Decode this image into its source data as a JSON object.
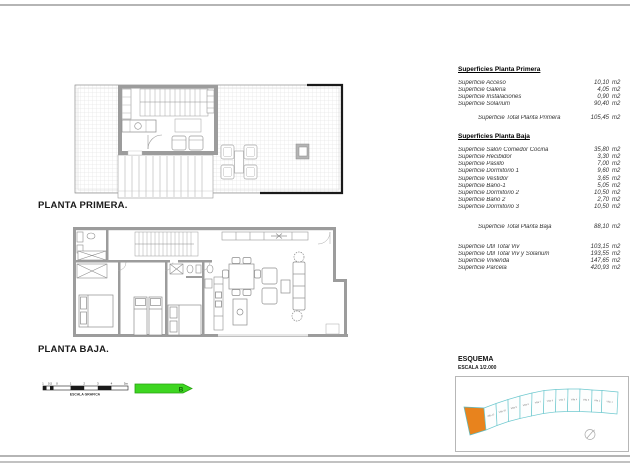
{
  "plans": {
    "primera_label": "PLANTA PRIMERA.",
    "baja_label": "PLANTA BAJA."
  },
  "common": {
    "unit": "m2"
  },
  "surfaces_primera": {
    "title": "Superficies Planta Primera",
    "rows": [
      {
        "label": "Superficie Acceso",
        "value": "10,10"
      },
      {
        "label": "Superficie Galeria",
        "value": "4,05"
      },
      {
        "label": "Superficie Instalaciones",
        "value": "0,90"
      },
      {
        "label": "Superficie Solarium",
        "value": "90,40"
      }
    ],
    "total_label": "Superficie Total Planta Primera",
    "total_value": "105,45"
  },
  "surfaces_baja": {
    "title": "Superficies Planta Baja",
    "rows": [
      {
        "label": "Superficie Salón Comedor Cocina",
        "value": "35,80"
      },
      {
        "label": "Superficie Recibidor",
        "value": "3,30"
      },
      {
        "label": "Superficie Pasillo",
        "value": "7,00"
      },
      {
        "label": "Superficie Dormitorio 1",
        "value": "9,60"
      },
      {
        "label": "Superficie Vestidor",
        "value": "3,65"
      },
      {
        "label": "Superficie Baño-1",
        "value": "5,05"
      },
      {
        "label": "Superficie Dormitorio 2",
        "value": "10,50"
      },
      {
        "label": "Superficie Baño 2",
        "value": "2,70"
      },
      {
        "label": "Superficie Dormitorio 3",
        "value": "10,50"
      }
    ],
    "total_label": "Superficie Total Planta Baja",
    "total_value": "88,10"
  },
  "summary": {
    "rows": [
      {
        "label": "Superficie Util Total Viv",
        "value": "103,15"
      },
      {
        "label": "Superficie Util Total Viv y Solarium",
        "value": "193,55"
      },
      {
        "label": "Superficie Vivienda",
        "value": "147,65"
      },
      {
        "label": "Superficie Parcela",
        "value": "420,93"
      }
    ]
  },
  "scalebar": {
    "ticks": [
      "1",
      "0,5",
      "0",
      "1",
      "2",
      "3",
      "4",
      "5m"
    ],
    "label": "ESCALA GRAFICA",
    "arrow_letter": "B",
    "arrow_color": "#3ed621"
  },
  "esquema": {
    "title": "ESQUEMA",
    "scale": "ESCALA 1/2.000",
    "highlight_color": "#e8831d",
    "plot_outline_color": "#6fc9cf",
    "plots": [
      {
        "label": "Villa 11"
      },
      {
        "label": "Villa 10"
      },
      {
        "label": "Villa 9"
      },
      {
        "label": "Villa 8"
      },
      {
        "label": "Villa 7"
      },
      {
        "label": "Villa 6"
      },
      {
        "label": "Villa 5"
      },
      {
        "label": "Villa 4"
      },
      {
        "label": "Villa 3"
      },
      {
        "label": "Villa 2"
      },
      {
        "label": "Villa 1"
      }
    ]
  }
}
